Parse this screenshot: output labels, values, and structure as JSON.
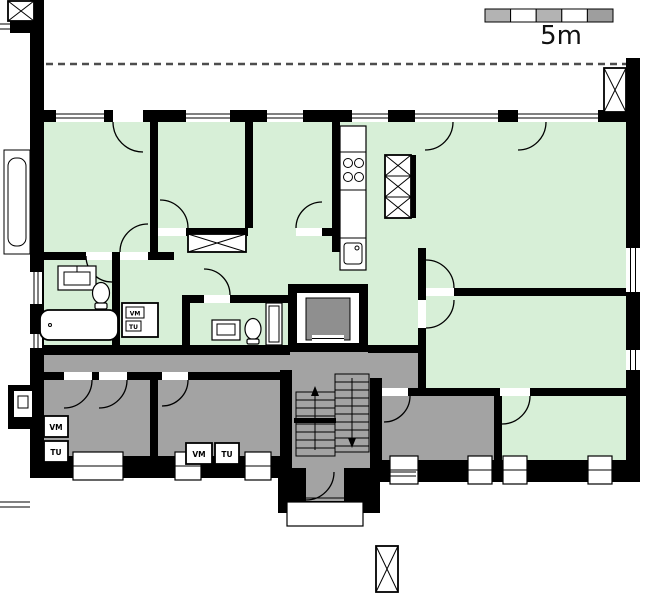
{
  "drawing": {
    "type": "apartment-building-floor-plan",
    "scale_label": "5m"
  },
  "labels": {
    "washing_machine": "VM",
    "dryer": "TU"
  },
  "appliance_groups": [
    {
      "location": "hall-closet",
      "items": [
        "VM",
        "TU"
      ]
    },
    {
      "location": "laundry-room-left",
      "items": [
        "VM",
        "TU"
      ]
    },
    {
      "location": "laundry-room-right",
      "items": [
        "VM",
        "TU"
      ]
    }
  ],
  "colors": {
    "paper": "#ffffff",
    "wall": "#000000",
    "apartment_fill": "#d7efd7",
    "common_fill": "#a3a3a3",
    "elevator_car": "#8f8f8f",
    "scale_segment": "#b3b3b3",
    "scale_segment_dark": "#9e9e9e",
    "dashed_line": "#4d4d4d"
  }
}
